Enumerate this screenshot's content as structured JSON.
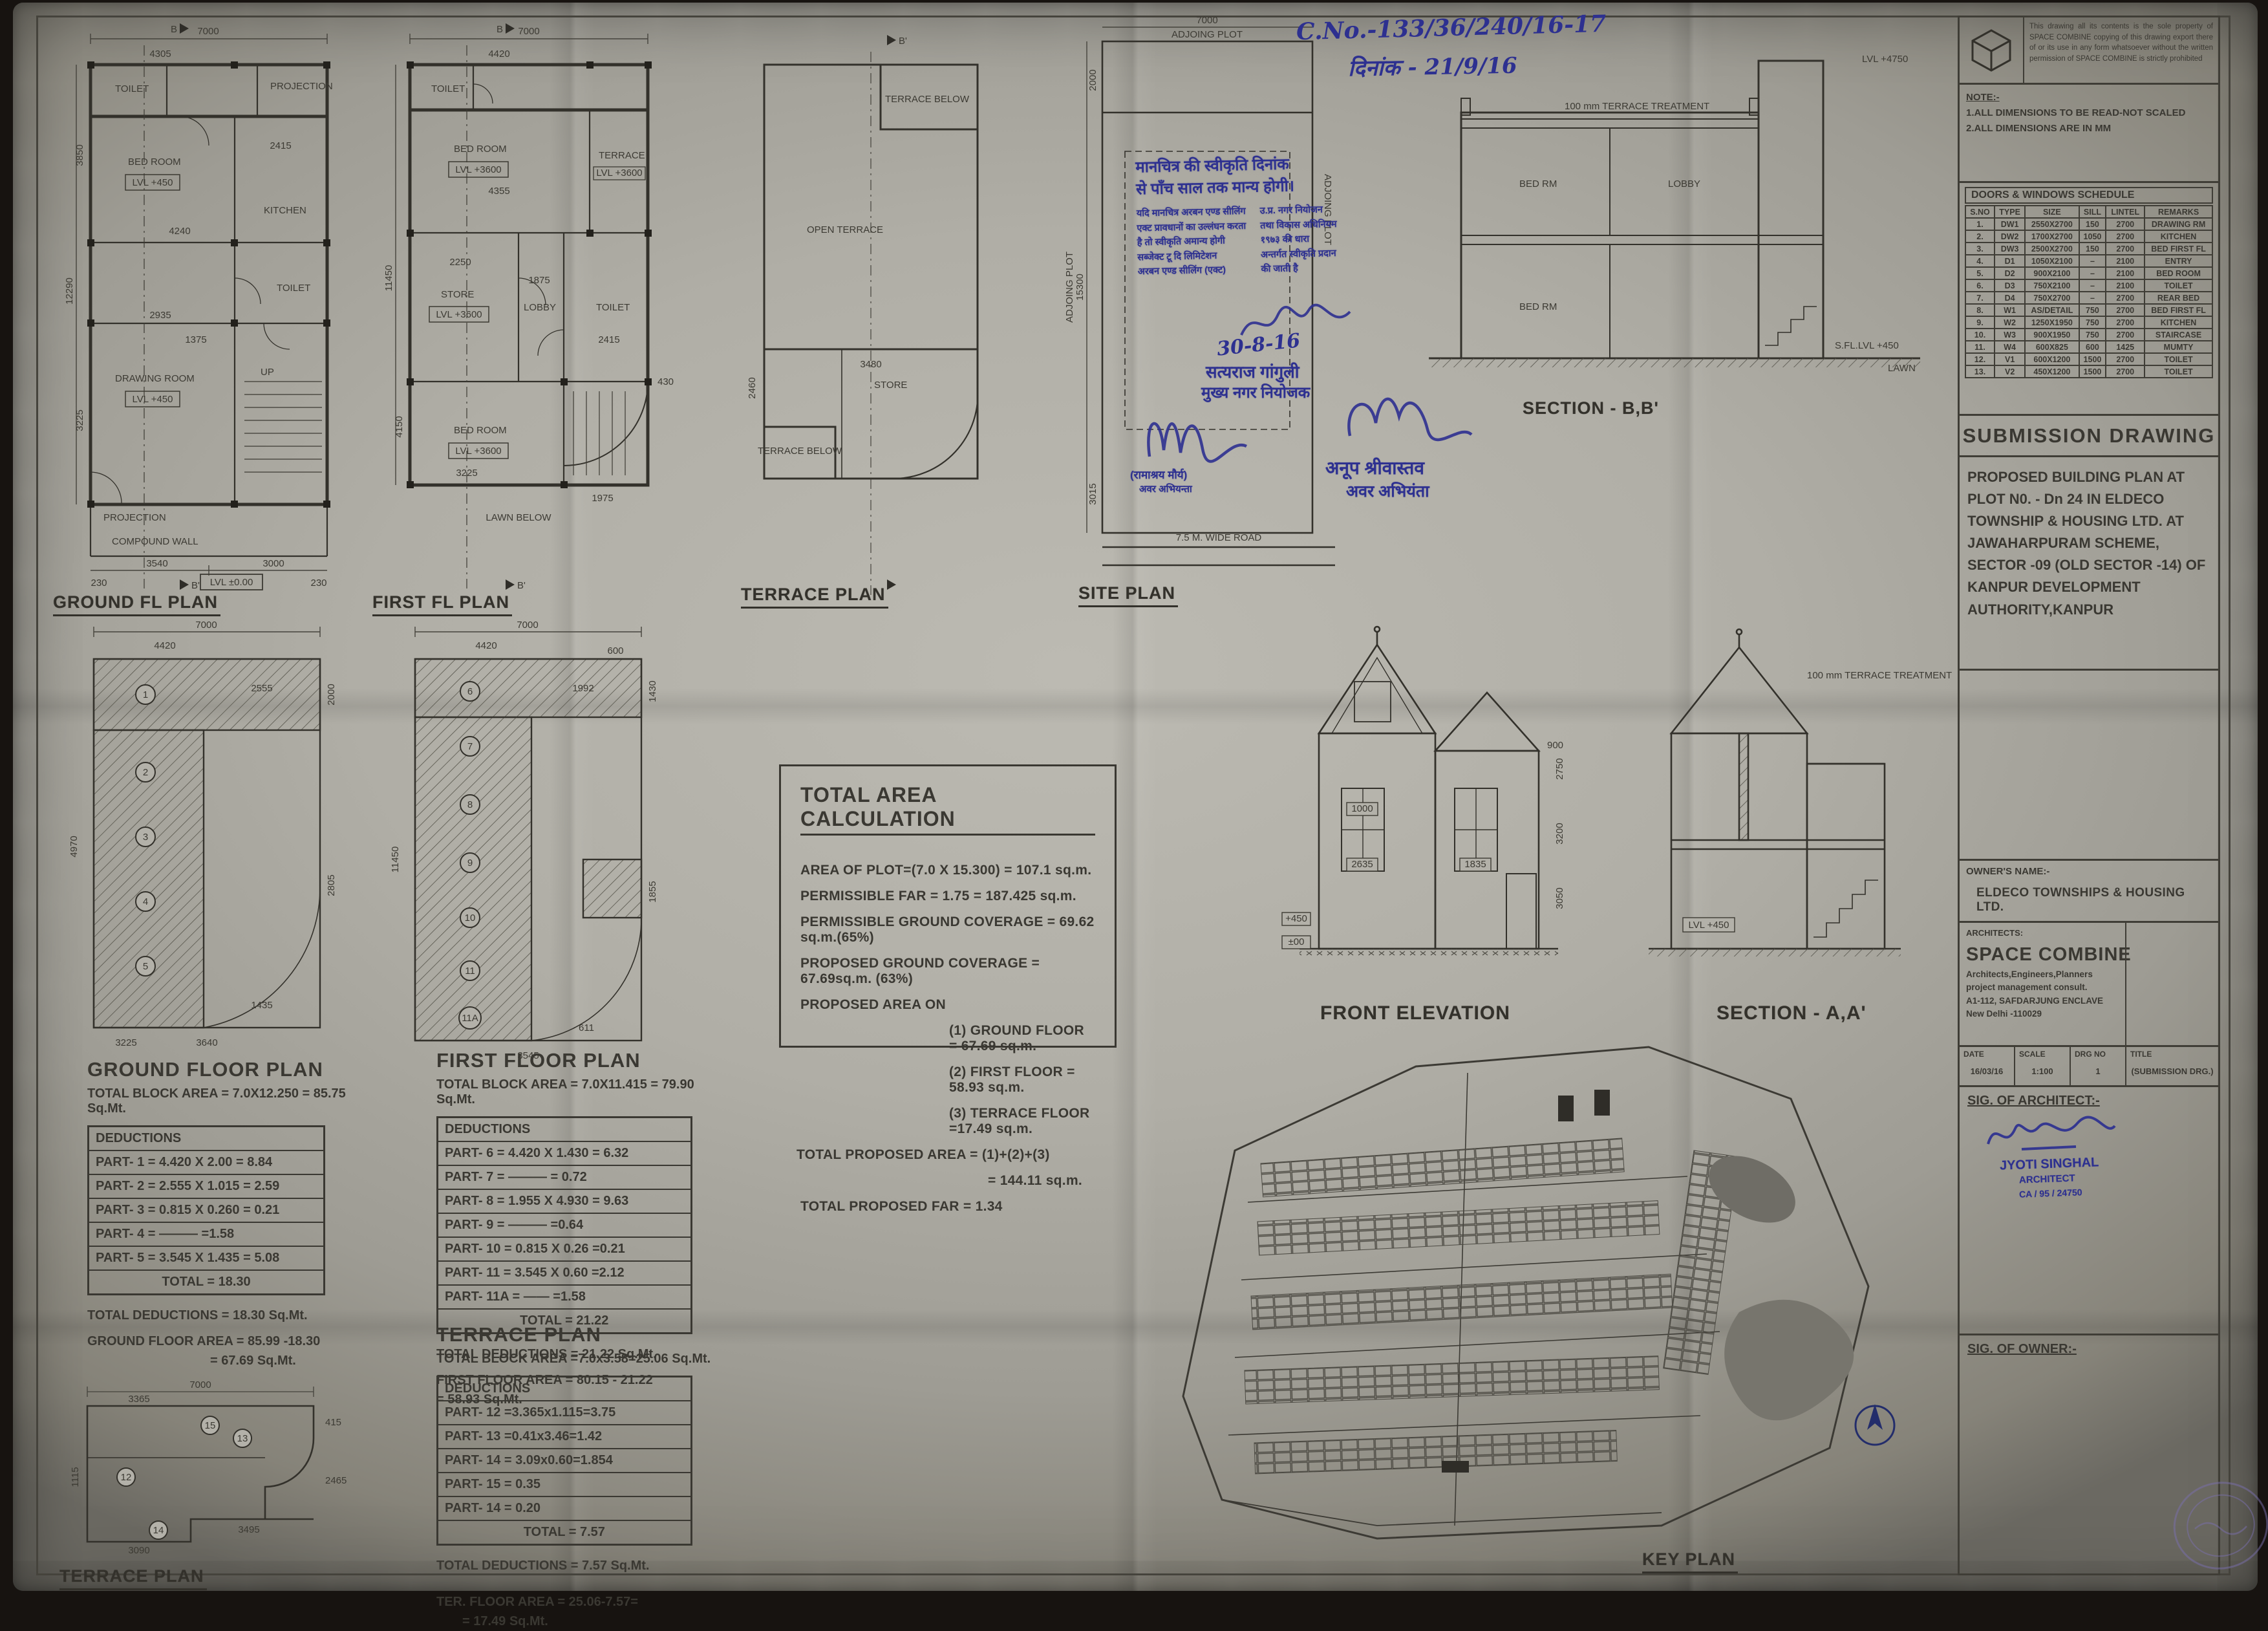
{
  "handwriting": {
    "ref_no": "C.No.-133/36/240/16-17",
    "date_line": "दिनांक - 21/9/16",
    "approve_date": "30-8-16"
  },
  "stamp": {
    "line1": "मानचित्र की स्वीकृति दिनांक",
    "line2": "से पाँच साल तक मान्य होगी।",
    "left": [
      "यदि मानचित्र अरबन एण्ड सीलिंग",
      "एक्ट प्रावधानों का उल्लंघन करता",
      "है तो स्वीकृति अमान्य होगी",
      "सब्जेक्ट टू दि लिमिटेशन",
      "अरबन एण्ड सीलिंग (एक्ट)"
    ],
    "right": [
      "उ.प्र. नगर नियोजन",
      "तथा विकास अधिनियम",
      "१९७३ की धारा",
      "अन्तर्गत स्वीकृति प्रदान",
      "की जाती है"
    ]
  },
  "officers": {
    "planner_name": "सत्यराज गांगुली",
    "planner_title": "मुख्य नगर नियोजक",
    "je_left_name": "(रामाश्रय मौर्य)",
    "je_left_title": "अवर अभियन्ता",
    "je_right_name": "अनूप श्रीवास्तव",
    "je_right_title": "अवर अभियंता"
  },
  "plans": {
    "ground": {
      "label": "GROUND FL PLAN",
      "lvl": "LVL +450",
      "lvl0": "LVL ±0.00",
      "rooms": {
        "toilet": "TOILET",
        "bed": "BED ROOM",
        "kitchen": "KITCHEN",
        "drawing": "DRAWING ROOM",
        "projection": "PROJECTION",
        "compound": "COMPOUND WALL",
        "up": "UP"
      },
      "dims": [
        "7000",
        "4305",
        "4240",
        "2935",
        "2415",
        "1375",
        "3540",
        "3000",
        "230",
        "230",
        "12290",
        "3850",
        "3225"
      ]
    },
    "first": {
      "label": "FIRST FL PLAN",
      "lvl": "LVL +3600",
      "rooms": {
        "toilet": "TOILET",
        "bed1": "BED ROOM",
        "terrace": "TERRACE",
        "store": "STORE",
        "lobby": "LOBBY",
        "bed2": "BED ROOM",
        "lawn": "LAWN BELOW"
      },
      "dims": [
        "7000",
        "4420",
        "4355",
        "2250",
        "1875",
        "2405",
        "2415",
        "3225",
        "1975",
        "11450",
        "4150",
        "430"
      ]
    },
    "terrace": {
      "label": "TERRACE PLAN",
      "rooms": {
        "open": "OPEN TERRACE",
        "below1": "TERRACE BELOW",
        "store": "STORE",
        "below2": "TERRACE BELOW"
      },
      "dims": [
        "3480",
        "2460"
      ]
    },
    "site": {
      "label": "SITE PLAN",
      "road": "7.5 M. WIDE ROAD",
      "adjoining": "ADJOING PLOT",
      "dims": [
        "7000",
        "2000",
        "15300",
        "3015"
      ]
    }
  },
  "markers": {
    "b": "B",
    "bp": "B'",
    "a": "A",
    "ap": "A'"
  },
  "sections": {
    "bb": {
      "label": "SECTION - B,B'",
      "treat": "100 mm TERRACE TREATMENT",
      "bed1": "BED RM",
      "lobby": "LOBBY",
      "bed2": "BED RM",
      "lawn": "LAWN",
      "sfl": "S.FL.LVL +450",
      "top": "LVL +4750"
    },
    "aa": {
      "label": "SECTION - A,A'",
      "treat": "100 mm TERRACE TREATMENT",
      "lvl": "LVL +450"
    }
  },
  "elevation": {
    "label": "FRONT ELEVATION",
    "dims": [
      "2750",
      "3200",
      "3050",
      "1000",
      "2635",
      "1835",
      "900",
      "+450",
      "±00"
    ]
  },
  "ded_gf": {
    "circles": [
      "1",
      "2",
      "3",
      "4",
      "5"
    ],
    "dims": [
      "7000",
      "4420",
      "2555",
      "2000",
      "4970",
      "2805",
      "3640",
      "1435",
      "3225"
    ]
  },
  "ded_ff": {
    "circles": [
      "6",
      "7",
      "8",
      "9",
      "10",
      "11",
      "11A"
    ],
    "dims": [
      "7000",
      "4420",
      "600",
      "1992",
      "1430",
      "11450",
      "1855",
      "3545",
      "611"
    ]
  },
  "ded_ter": {
    "label": "TERRACE PLAN",
    "circles": [
      "12",
      "13",
      "14",
      "15"
    ],
    "dims": [
      "7000",
      "3365",
      "415",
      "1115",
      "2465",
      "3090",
      "3495"
    ]
  },
  "key_plan": {
    "label": "KEY PLAN"
  },
  "area_calc": {
    "title": "TOTAL AREA CALCULATION",
    "plot": "AREA OF PLOT=(7.0 X 15.300) = 107.1  sq.m.",
    "far": "PERMISSIBLE FAR = 1.75 = 187.425 sq.m.",
    "pgc": "PERMISSIBLE GROUND COVERAGE  = 69.62 sq.m.(65%)",
    "prgc": "PROPOSED GROUND COVERAGE  = 67.69sq.m. (63%)",
    "on": "PROPOSED AREA ON",
    "g": "(1) GROUND FLOOR    = 67.69 sq.m.",
    "f": "(2) FIRST FLOOR       = 58.93 sq.m.",
    "t": "(3) TERRACE FLOOR  =17.49 sq.m.",
    "tot1": "TOTAL PROPOSED AREA   = (1)+(2)+(3)",
    "tot2": "= 144.11 sq.m.",
    "far2": "TOTAL PROPOSED FAR   = 1.34"
  },
  "gf_table": {
    "title": "GROUND FLOOR PLAN",
    "block": "TOTAL BLOCK AREA = 7.0X12.250 = 85.75 Sq.Mt.",
    "ded": "DEDUCTIONS",
    "rows": [
      "PART- 1 = 4.420 X 2.00 = 8.84",
      "PART- 2 = 2.555 X 1.015 = 2.59",
      "PART- 3 = 0.815 X 0.260 = 0.21",
      "PART- 4 =    ———  =1.58",
      "PART- 5 = 3.545 X 1.435 = 5.08"
    ],
    "total": "TOTAL  = 18.30",
    "foot1": "TOTAL DEDUCTIONS     = 18.30 Sq.Mt.",
    "foot2": "GROUND FLOOR AREA  = 85.99 -18.30",
    "foot3": "= 67.69  Sq.Mt."
  },
  "ff_table": {
    "title": "FIRST FLOOR PLAN",
    "block": "TOTAL BLOCK AREA = 7.0X11.415 = 79.90 Sq.Mt.",
    "ded": "DEDUCTIONS",
    "rows": [
      "PART- 6 = 4.420 X 1.430 = 6.32",
      "PART- 7 =   ———   = 0.72",
      "PART- 8 = 1.955 X 4.930 = 9.63",
      "PART- 9 =   ———  =0.64",
      "PART- 10 = 0.815 X 0.26 =0.21",
      "PART- 11 = 3.545 X 0.60 =2.12",
      "PART- 11A =  ——   =1.58"
    ],
    "total": "TOTAL  = 21.22",
    "foot1": "TOTAL DEDUCTIONS     = 21.22 Sq.Mt.",
    "foot2": "FIRST FLOOR AREA  = 80.15 - 21.22",
    "foot3": "= 58.93 Sq.Mt."
  },
  "ter_table": {
    "title": "TERRACE PLAN",
    "block": "TOTAL BLOCK AREA =7.0x3.58=25.06 Sq.Mt.",
    "ded": "DEDUCTIONS",
    "rows": [
      "PART- 12 =3.365x1.115=3.75",
      "PART- 13 =0.41x3.46=1.42",
      "PART- 14 = 3.09x0.60=1.854",
      "PART- 15                    = 0.35",
      "PART- 14                    = 0.20"
    ],
    "total": "TOTAL  = 7.57",
    "foot1": "TOTAL DEDUCTIONS = 7.57 Sq.Mt.",
    "foot2": "TER. FLOOR AREA  = 25.06-7.57=",
    "foot3": "= 17.49  Sq.Mt."
  },
  "title_block": {
    "copyright": "This drawing all its contents is the sole property of SPACE COMBINE copying of this drawing export there of or its use in any form whatsoever without the written permission of SPACE COMBINE is strictly prohibited",
    "note_title": "NOTE:-",
    "note1": "1.ALL DIMENSIONS TO BE READ-NOT SCALED",
    "note2": "2.ALL DIMENSIONS ARE IN MM",
    "schedule": {
      "title": "DOORS & WINDOWS SCHEDULE",
      "headers": [
        "S.NO",
        "TYPE",
        "SIZE",
        "SILL",
        "LINTEL",
        "REMARKS"
      ],
      "rows": [
        [
          "1.",
          "DW1",
          "2550X2700",
          "150",
          "2700",
          "DRAWING RM"
        ],
        [
          "2.",
          "DW2",
          "1700X2700",
          "1050",
          "2700",
          "KITCHEN"
        ],
        [
          "3.",
          "DW3",
          "2500X2700",
          "150",
          "2700",
          "BED FIRST FL"
        ],
        [
          "4.",
          "D1",
          "1050X2100",
          "–",
          "2100",
          "ENTRY"
        ],
        [
          "5.",
          "D2",
          "900X2100",
          "–",
          "2100",
          "BED ROOM"
        ],
        [
          "6.",
          "D3",
          "750X2100",
          "–",
          "2100",
          "TOILET"
        ],
        [
          "7.",
          "D4",
          "750X2700",
          "–",
          "2700",
          "REAR BED"
        ],
        [
          "8.",
          "W1",
          "AS/DETAIL",
          "750",
          "2700",
          "BED FIRST FL"
        ],
        [
          "9.",
          "W2",
          "1250X1950",
          "750",
          "2700",
          "KITCHEN"
        ],
        [
          "10.",
          "W3",
          "900X1950",
          "750",
          "2700",
          "STAIRCASE"
        ],
        [
          "11.",
          "W4",
          "600X825",
          "600",
          "1425",
          "MUMTY"
        ],
        [
          "12.",
          "V1",
          "600X1200",
          "1500",
          "2700",
          "TOILET"
        ],
        [
          "13.",
          "V2",
          "450X1200",
          "1500",
          "2700",
          "TOILET"
        ]
      ]
    },
    "submission": "SUBMISSION DRAWING",
    "project": "PROPOSED BUILDING PLAN AT PLOT N0. - Dn 24  IN ELDECO TOWNSHIP & HOUSING LTD. AT JAWAHARPURAM SCHEME,  SECTOR -09 (OLD SECTOR -14) OF KANPUR DEVELOPMENT AUTHORITY,KANPUR",
    "owner_label": "OWNER'S NAME:-",
    "owner": "ELDECO TOWNSHIPS & HOUSING LTD.",
    "arch_label": "ARCHITECTS:",
    "arch_name": "SPACE COMBINE",
    "arch_l1": "Architects,Engineers,Planners",
    "arch_l2": "project management consult.",
    "arch_l3": "A1-112, SAFDARJUNG  ENCLAVE",
    "arch_l4": "New Delhi -110029",
    "meta_h": [
      "DATE",
      "SCALE",
      "DRG NO",
      "TITLE"
    ],
    "meta_v": [
      "16/03/16",
      "1:100",
      "1",
      "(SUBMISSION DRG.)"
    ],
    "sig_arch": "SIG. OF ARCHITECT:-",
    "sig_owner": "SIG. OF OWNER:-",
    "arch_stamp1": "JYOTI SINGHAL",
    "arch_stamp2": "ARCHITECT",
    "arch_stamp3": "CA / 95 / 24750"
  }
}
